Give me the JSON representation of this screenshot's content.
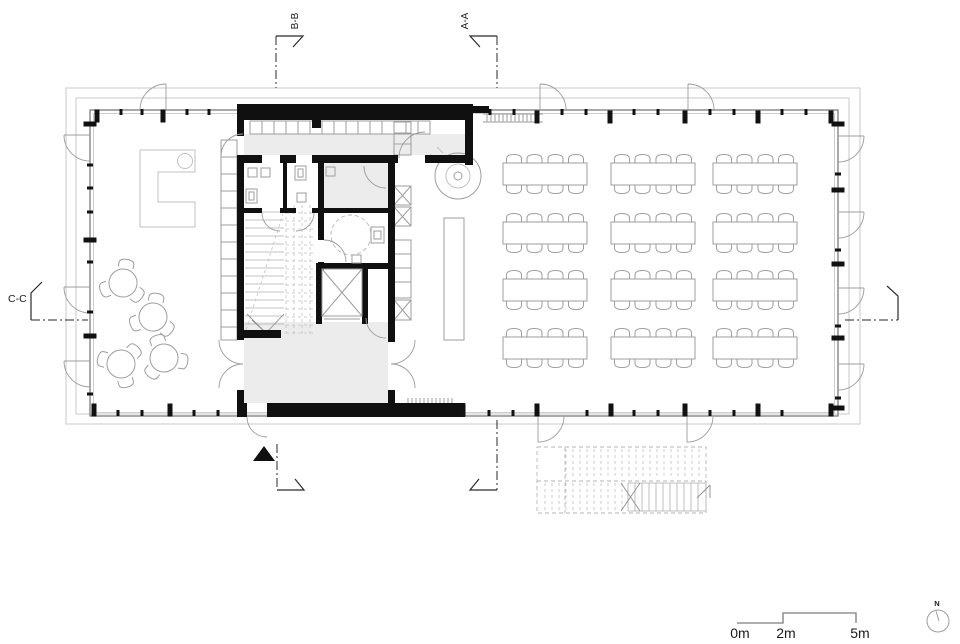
{
  "drawing": {
    "section_labels": {
      "bb": "B-B",
      "aa": "A-A",
      "cc": "C-C"
    },
    "scale_bar": {
      "m0": "0m",
      "m2": "2m",
      "m5": "5m"
    },
    "compass": {
      "label": "N"
    },
    "colors": {
      "wall": "#101010",
      "thin": "#7d7d7d",
      "light": "#c2c2c2",
      "furniture": "#9e9e9e",
      "floor": "#ececec",
      "section": "#2a2a2a",
      "paper": "#ffffff"
    }
  }
}
